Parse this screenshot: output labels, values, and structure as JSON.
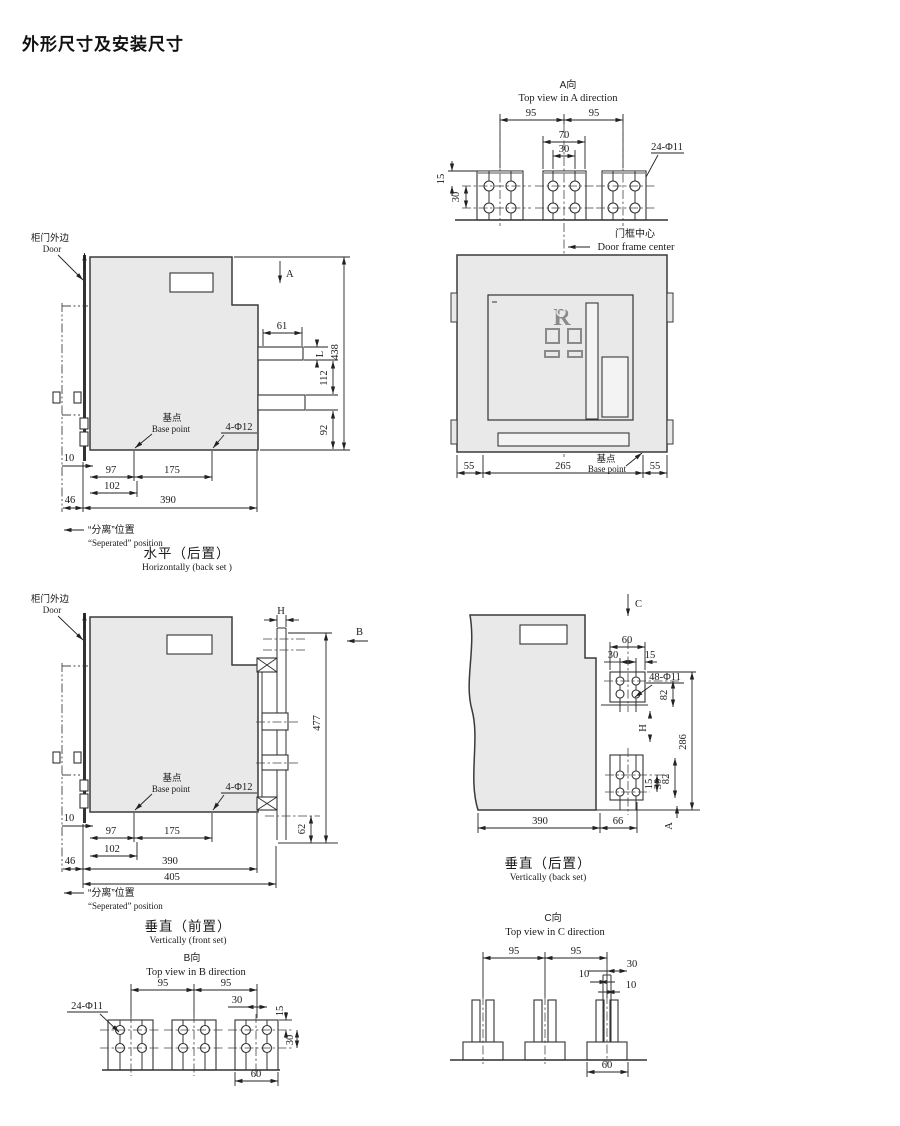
{
  "title": "外形尺寸及安装尺寸",
  "views": {
    "top_a": {
      "cn": "A向",
      "en": "Top view in A direction",
      "d95a": "95",
      "d95b": "95",
      "d70": "70",
      "d30": "30",
      "r15": "15",
      "r30": "30",
      "holes": "24-Φ11"
    },
    "front": {
      "center_cn": "门框中心",
      "center_en": "Door frame center",
      "d55a": "55",
      "d265": "265",
      "d55b": "55",
      "base_cn": "基点",
      "base_en": "Base point",
      "logo": "R"
    },
    "horiz": {
      "door_cn": "柜门外边",
      "door_en": "Door",
      "secA": "A",
      "d61": "61",
      "dL": "L",
      "d438": "438",
      "d112": "112",
      "d92": "92",
      "d10": "10",
      "d97": "97",
      "d175": "175",
      "d102": "102",
      "d46": "46",
      "d390": "390",
      "base_cn": "基点",
      "base_en": "Base point",
      "holes": "4-Φ12",
      "sep_cn": "“分离”位置",
      "sep_en": "“Seperated”  position",
      "cap_cn": "水平（后置）",
      "cap_en": "Horizontally (back set )"
    },
    "vfront": {
      "door_cn": "柜门外边",
      "door_en": "Door",
      "dH": "H",
      "dB": "B",
      "d477": "477",
      "d62": "62",
      "d10": "10",
      "d97": "97",
      "d175": "175",
      "d102": "102",
      "d46": "46",
      "d390": "390",
      "d405": "405",
      "base_cn": "基点",
      "base_en": "Base point",
      "holes": "4-Φ12",
      "sep_cn": "“分离”位置",
      "sep_en": "“Seperated”  position",
      "cap_cn": "垂直（前置）",
      "cap_en": "Vertically (front set)"
    },
    "vback": {
      "secC": "C",
      "d60": "60",
      "d30": "30",
      "d15": "15",
      "holes": "48-Φ11",
      "d82a": "82",
      "dH": "H",
      "d286": "286",
      "d82b": "82",
      "r15": "15",
      "r30": "30",
      "dA": "A",
      "d390": "390",
      "d66": "66",
      "cap_cn": "垂直（后置）",
      "cap_en": "Vertically (back set)"
    },
    "top_b": {
      "cn": "B向",
      "en": "Top view in B direction",
      "d95a": "95",
      "d95b": "95",
      "d30": "30",
      "r15": "15",
      "r30": "30",
      "d60": "60",
      "holes": "24-Φ11"
    },
    "top_c": {
      "cn": "C向",
      "en": "Top view in C direction",
      "d95a": "95",
      "d95b": "95",
      "d30": "30",
      "d10a": "10",
      "d10b": "10",
      "d60": "60"
    }
  }
}
